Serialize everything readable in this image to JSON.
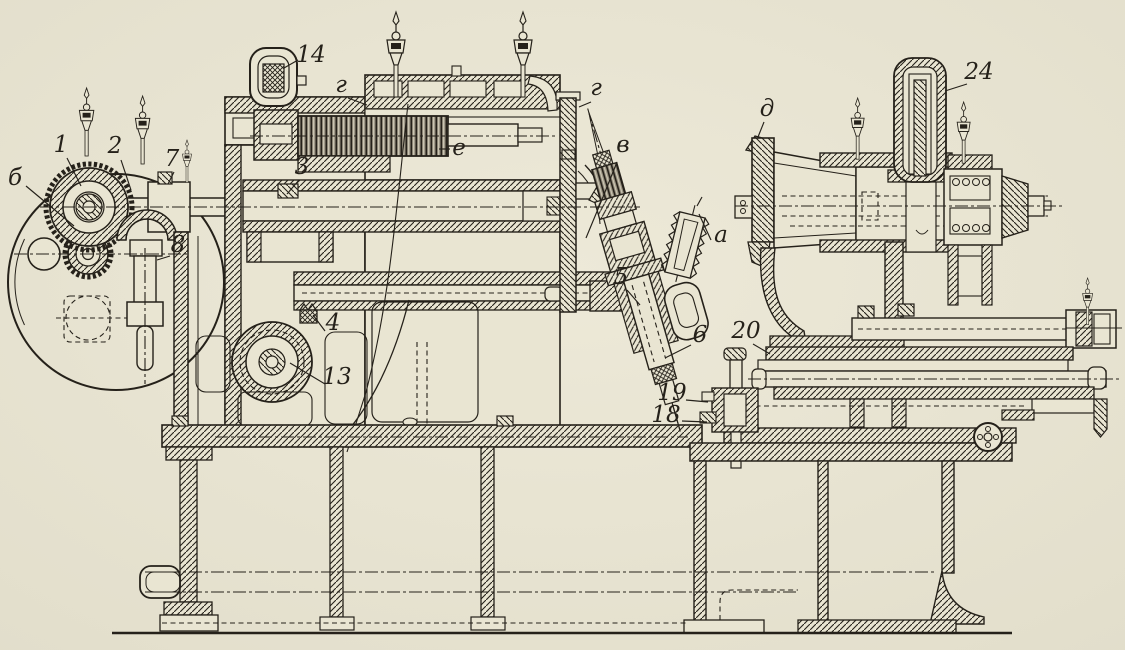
{
  "colors": {
    "paper": "#e9e5d2",
    "ink": "#25211a"
  },
  "figure": {
    "kind": "sectional machine drawing",
    "labels": [
      {
        "id": "b",
        "text": "б"
      },
      {
        "id": "n1",
        "text": "1"
      },
      {
        "id": "n2",
        "text": "2"
      },
      {
        "id": "n7",
        "text": "7"
      },
      {
        "id": "n8",
        "text": "8"
      },
      {
        "id": "n14",
        "text": "14"
      },
      {
        "id": "g-left",
        "text": "г"
      },
      {
        "id": "e",
        "text": "е"
      },
      {
        "id": "n3",
        "text": "3"
      },
      {
        "id": "g-right",
        "text": "г"
      },
      {
        "id": "v",
        "text": "в"
      },
      {
        "id": "a",
        "text": "а"
      },
      {
        "id": "n5",
        "text": "5"
      },
      {
        "id": "n6",
        "text": "6"
      },
      {
        "id": "n4",
        "text": "4"
      },
      {
        "id": "n13",
        "text": "13"
      },
      {
        "id": "d",
        "text": "д"
      },
      {
        "id": "n24",
        "text": "24"
      },
      {
        "id": "n20",
        "text": "20"
      },
      {
        "id": "n19",
        "text": "19"
      },
      {
        "id": "n18",
        "text": "18"
      }
    ]
  }
}
